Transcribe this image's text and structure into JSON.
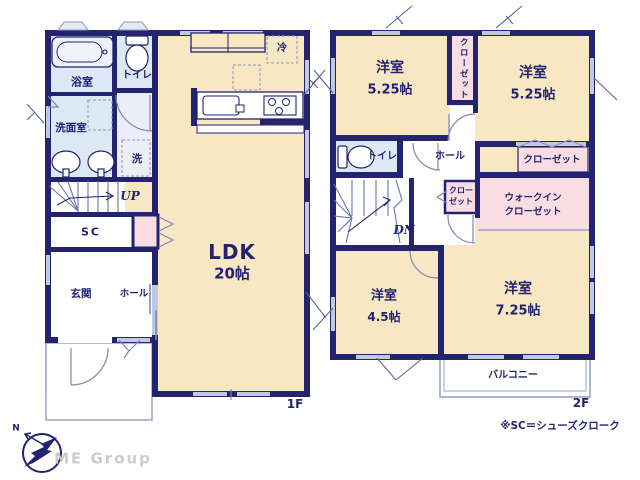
{
  "floor1": {
    "label": "1F",
    "bathroom": "浴室",
    "toilet": "トイレ",
    "washroom": "洗面室",
    "laundry": "洗",
    "refrigerator": "冷",
    "stairs_direction": "UP",
    "shoe_cloak": "SC",
    "entrance": "玄関",
    "hall": "ホール",
    "ldk": {
      "name": "LDK",
      "size": "20帖"
    }
  },
  "floor2": {
    "label": "2F",
    "bedroom_nw": {
      "name": "洋室",
      "size": "5.25帖"
    },
    "bedroom_ne": {
      "name": "洋室",
      "size": "5.25帖"
    },
    "bedroom_sw": {
      "name": "洋室",
      "size": "4.5帖"
    },
    "bedroom_se": {
      "name": "洋室",
      "size": "7.25帖"
    },
    "closet_vertical": "クローゼット",
    "toilet": "トイレ",
    "hall": "ホール",
    "closet_small": {
      "line1": "クロー",
      "line2": "ゼット"
    },
    "closet_ne": "クローゼット",
    "walk_in_closet": {
      "line1": "ウォークイン",
      "line2": "クローゼット"
    },
    "stairs_direction": "DN",
    "balcony": "バルコニー"
  },
  "footer": {
    "note": "※SC＝シューズクローク",
    "brand": "ME Group",
    "compass_north": "N"
  },
  "colors": {
    "wall": "#232370",
    "floor": "#f7e7c2",
    "wet_area": "#dce8f4",
    "closet": "#fadde2",
    "window": "#c3c9dd",
    "thin_line": "#8e96c0",
    "brand_text": "#cccccc"
  }
}
